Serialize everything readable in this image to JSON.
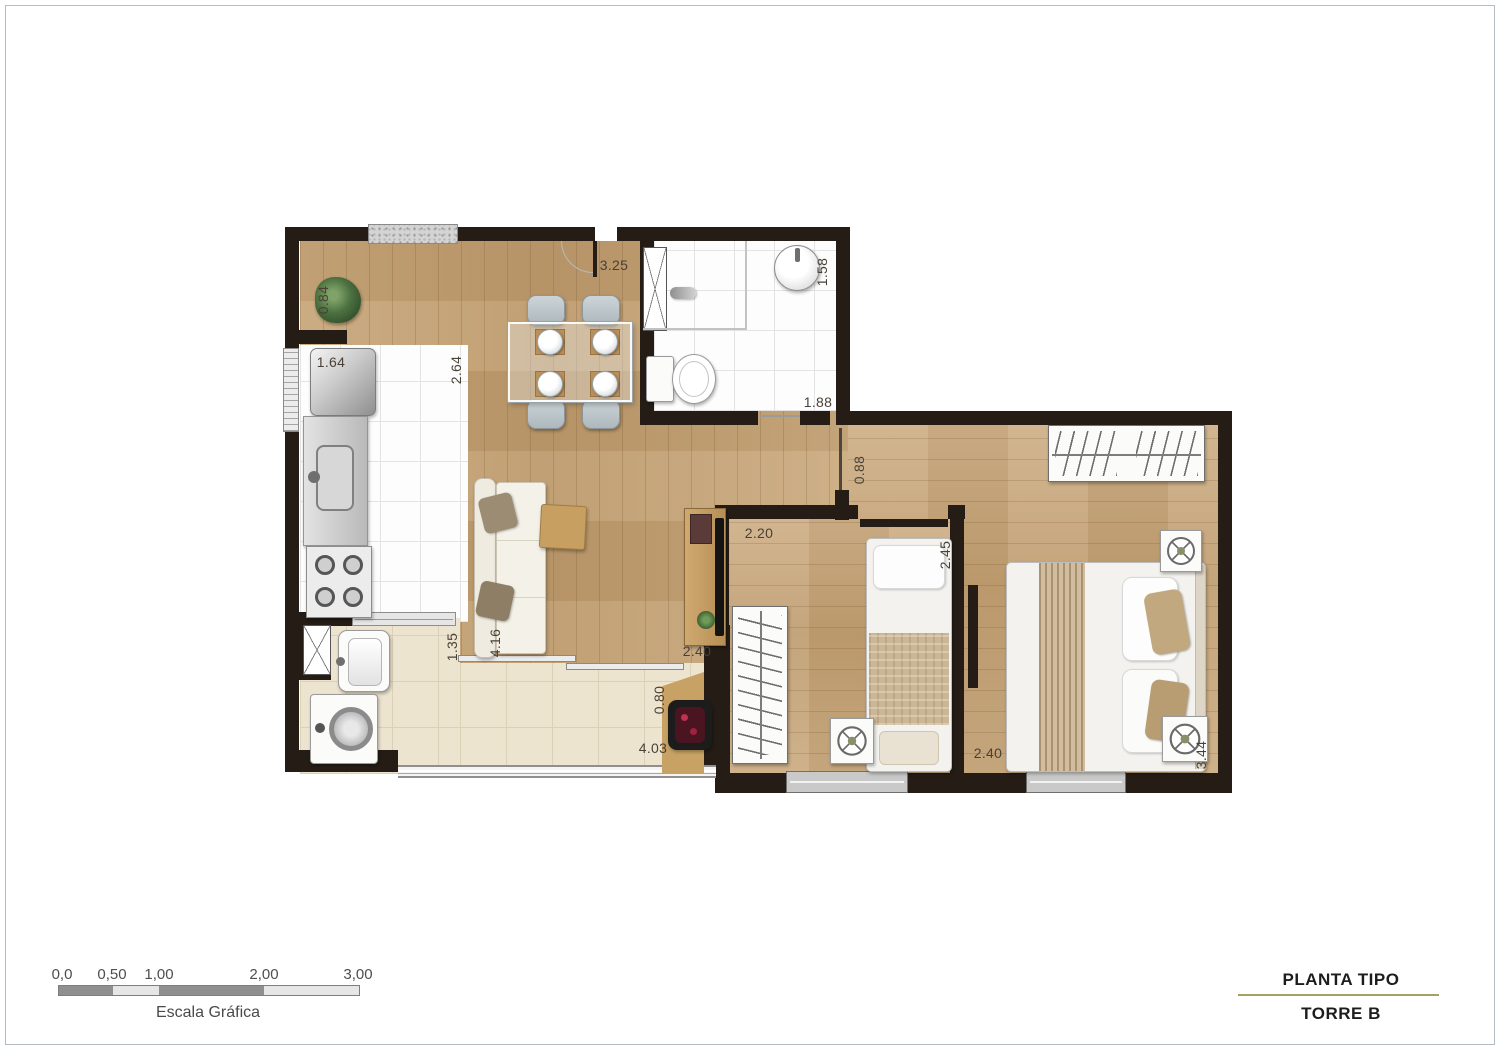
{
  "dims": {
    "ledge": "0.84",
    "living_top": "3.25",
    "bath_w": "1.58",
    "kitchen_w": "1.64",
    "kitchen_d": "2.64",
    "bath_d": "1.88",
    "hall_door": "0.88",
    "bed1_w": "2.20",
    "bed1_d": "2.45",
    "service_w": "1.35",
    "living_d": "4.16",
    "living_w2": "2.40",
    "balcony_d": "0.80",
    "balcony_w": "4.03",
    "bed2_w": "2.40",
    "bed2_d": "3.44"
  },
  "scale_bar": {
    "labels": [
      "0,0",
      "0,50",
      "1,00",
      "2,00",
      "3,00"
    ],
    "caption": "Escala Gráfica"
  },
  "title_block": {
    "line1": "PLANTA TIPO",
    "line2": "TORRE B"
  },
  "colors": {
    "wall": "#241c15",
    "wood": "#c3a175",
    "divider": "#a5a162"
  }
}
